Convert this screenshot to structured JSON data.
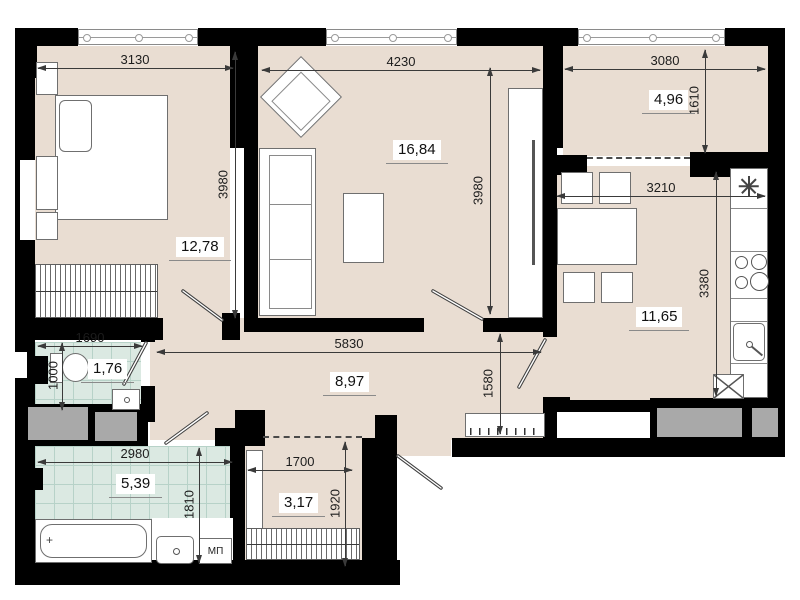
{
  "plan_type": "apartment-floor-plan",
  "rooms": {
    "bedroom": {
      "area": "12,78",
      "width_mm": "3130",
      "depth_mm": "3980"
    },
    "living_room": {
      "area": "16,84",
      "width_mm": "4230",
      "depth_mm": "3980"
    },
    "balcony": {
      "area": "4,96",
      "width_mm": "3080",
      "depth_mm": "1610"
    },
    "kitchen": {
      "area": "11,65",
      "width_mm": "3210",
      "depth_mm": "3380"
    },
    "hallway": {
      "area": "8,97",
      "width_mm": "5830",
      "depth_mm": "1580"
    },
    "wc": {
      "area": "1,76",
      "width_mm": "1690",
      "depth_mm": "1000"
    },
    "bathroom": {
      "area": "5,39",
      "width_mm": "2980",
      "depth_mm": "1810"
    },
    "entry_hall": {
      "area": "3,17",
      "width_mm": "1700",
      "depth_mm": "1920"
    }
  },
  "labels": {
    "washer_place": "МП",
    "tub_drain": "+"
  },
  "icons": {
    "fridge": "snowflake",
    "stove": "four-burners",
    "kitchen_vent": "crossed-square"
  },
  "colors": {
    "floor": "#e9ddd2",
    "tile_floor": "#dbe9e2",
    "wall": "#000000",
    "vent_shaft": "#a9a9a9",
    "dimension_text": "#1c1c1c"
  }
}
